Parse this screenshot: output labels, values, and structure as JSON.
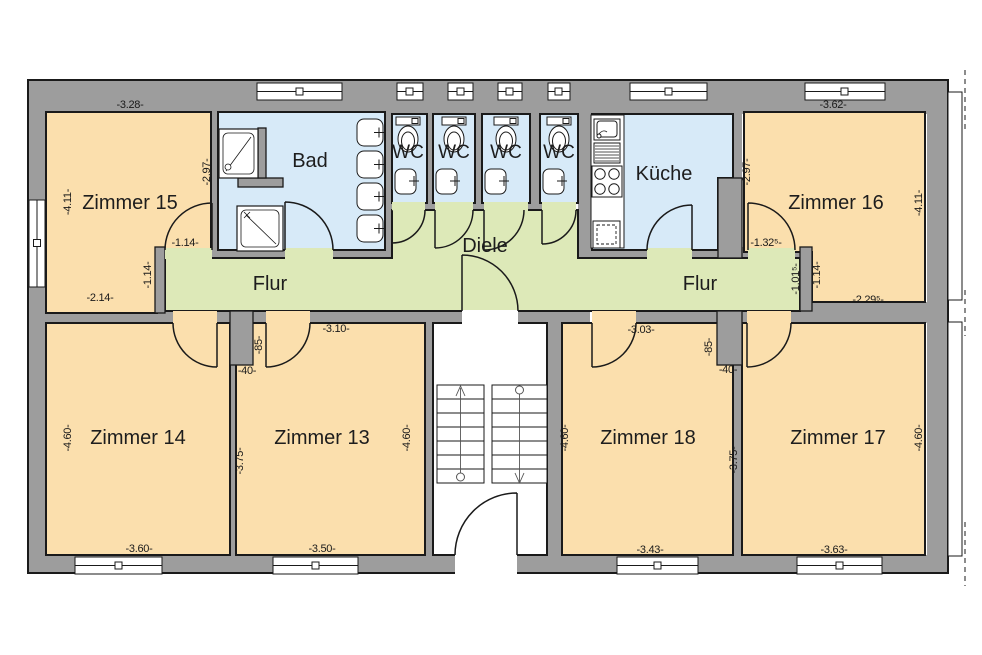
{
  "title": "Grundriss Obergeschoss",
  "colors": {
    "room_orange": "#fbdfad",
    "wet_blue": "#d7eaf8",
    "corridor_green": "#dde9b8",
    "wall_gray": "#9d9d9d",
    "line": "#1a1a1a",
    "white": "#ffffff"
  },
  "rooms": [
    {
      "id": "zimmer-15",
      "label": "Zimmer 15"
    },
    {
      "id": "bad",
      "label": "Bad"
    },
    {
      "id": "wc-1",
      "label": "WC"
    },
    {
      "id": "wc-2",
      "label": "WC"
    },
    {
      "id": "wc-3",
      "label": "WC"
    },
    {
      "id": "wc-4",
      "label": "WC"
    },
    {
      "id": "kueche",
      "label": "Küche"
    },
    {
      "id": "zimmer-16",
      "label": "Zimmer 16"
    },
    {
      "id": "flur-west",
      "label": "Flur"
    },
    {
      "id": "diele",
      "label": "Diele"
    },
    {
      "id": "flur-ost",
      "label": "Flur"
    },
    {
      "id": "zimmer-14",
      "label": "Zimmer 14"
    },
    {
      "id": "zimmer-13",
      "label": "Zimmer 13"
    },
    {
      "id": "zimmer-18",
      "label": "Zimmer 18"
    },
    {
      "id": "zimmer-17",
      "label": "Zimmer 17"
    }
  ],
  "dimensions": [
    {
      "text": "-3.28-"
    },
    {
      "text": "-3.62-"
    },
    {
      "text": "-1.14-"
    },
    {
      "text": "-2.14-"
    },
    {
      "text": "-1.32⁵-"
    },
    {
      "text": "-2.29⁵-"
    },
    {
      "text": "-3.10-"
    },
    {
      "text": "-3.03-"
    },
    {
      "text": "-40-"
    },
    {
      "text": "-40-"
    },
    {
      "text": "-3.60-"
    },
    {
      "text": "-3.50-"
    },
    {
      "text": "-3.43-"
    },
    {
      "text": "-3.63-"
    },
    {
      "text": "-4.11-"
    },
    {
      "text": "-2.97-"
    },
    {
      "text": "-1.14-"
    },
    {
      "text": "-2.97-"
    },
    {
      "text": "-4.11-"
    },
    {
      "text": "-1.01⁵-"
    },
    {
      "text": "-1.14-"
    },
    {
      "text": "-85-"
    },
    {
      "text": "-3.75-"
    },
    {
      "text": "-4.60-"
    },
    {
      "text": "-4.60-"
    },
    {
      "text": "-4.60-"
    },
    {
      "text": "-85-"
    },
    {
      "text": "-3.75-"
    },
    {
      "text": "-4.60-"
    }
  ]
}
